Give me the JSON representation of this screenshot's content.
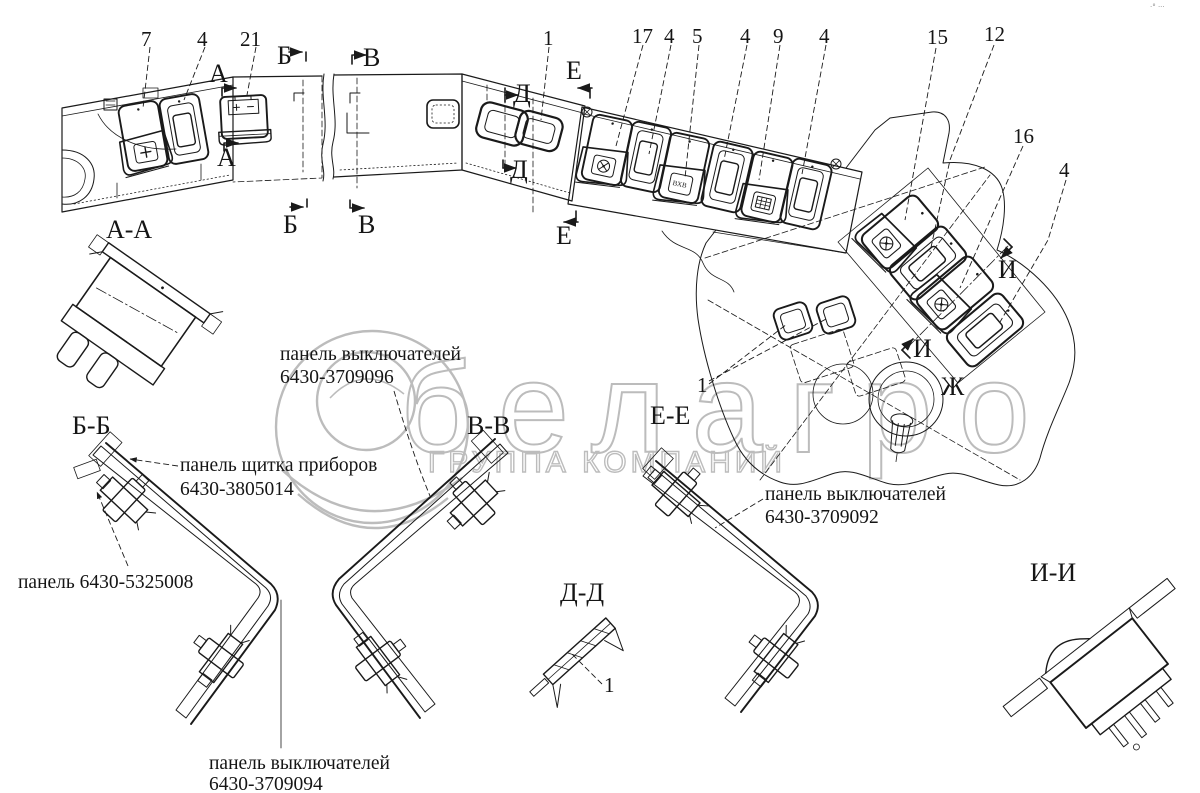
{
  "canvas": {
    "width": 1200,
    "height": 793,
    "background": "#ffffff",
    "ink_color": "#1a1a1a",
    "watermark_color": "#bcbcbc"
  },
  "watermark": {
    "brand": "белагро",
    "tagline": "ГРУППА КОМПАНИЙ"
  },
  "corner_mark": "·° ···",
  "callouts": {
    "n7": "7",
    "n4_left": "4",
    "n21": "21",
    "n1_top": "1",
    "n17": "17",
    "n4_mid1": "4",
    "n5": "5",
    "n4_mid2": "4",
    "n9": "9",
    "n4_mid3": "4",
    "n15": "15",
    "n12": "12",
    "n16": "16",
    "n4_right": "4",
    "n1_console": "1",
    "n1_section_dd": "1"
  },
  "section_marks": {
    "a_top": "А",
    "a_bottom": "А",
    "b_top": "Б",
    "b_bottom": "Б",
    "v_top": "В",
    "v_bottom": "В",
    "d_top": "Д",
    "d_bottom": "Д",
    "e_top": "Е",
    "e_bottom": "Е",
    "i_upper": "И",
    "i_lower": "И",
    "zh_view": "Ж"
  },
  "section_titles": {
    "aa": "А-А",
    "bb": "Б-Б",
    "vv": "В-В",
    "dd": "Д-Д",
    "ee": "Е-Е",
    "ii": "И-И"
  },
  "part_labels": {
    "panel_3709096": {
      "line1": "панель выключателей",
      "line2": "6430-3709096"
    },
    "panel_3805014": {
      "line1": "панель щитка приборов",
      "line2": "6430-3805014"
    },
    "panel_5325008": {
      "line1": "панель 6430-5325008"
    },
    "panel_3709092": {
      "line1": "панель выключателей",
      "line2": "6430-3709092"
    },
    "panel_3709094": {
      "line1": "панель выключателей",
      "line2": "6430-3709094"
    }
  },
  "switch_icons": {
    "heater_label": "ВХВ"
  }
}
